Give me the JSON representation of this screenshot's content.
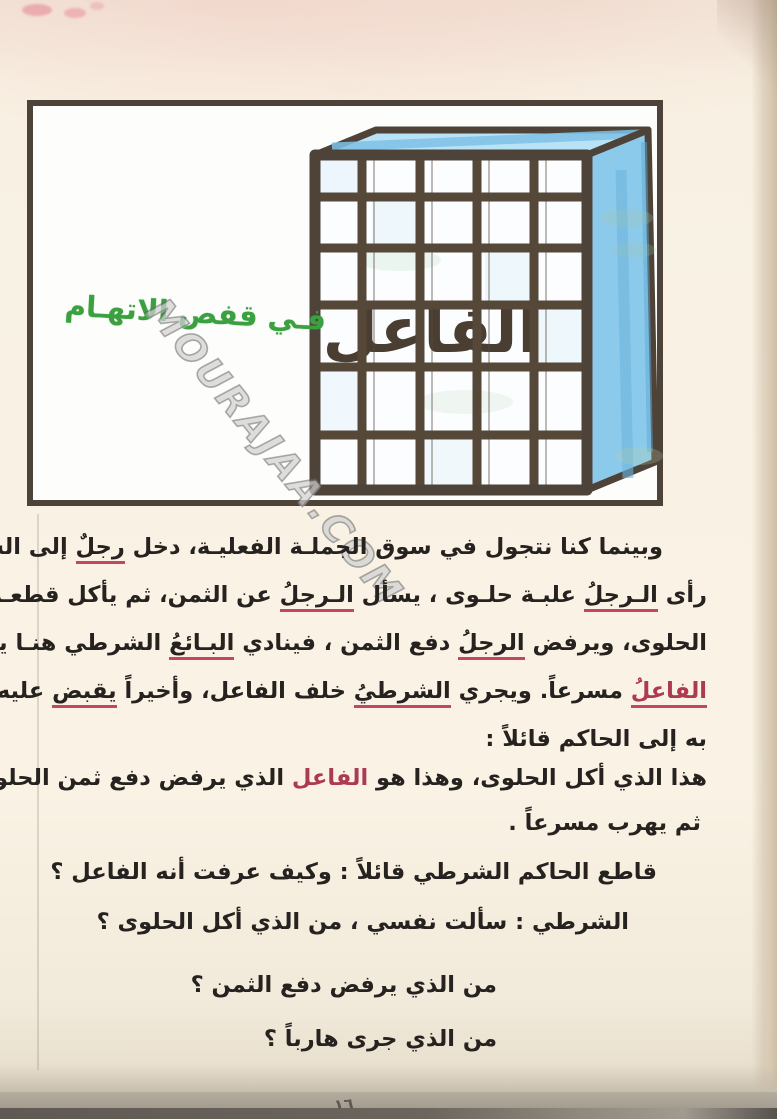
{
  "page": {
    "number": "١٦"
  },
  "colors": {
    "paper": "#f8f1e3",
    "frame_border": "#4e4338",
    "cage_bars": "#554838",
    "cage_side_blue": "#8ccaec",
    "cage_top_blue": "#b8e2f5",
    "title_green": "#3aa040",
    "highlight_red": "#ad3a53",
    "body_text": "#26221f"
  },
  "illustration": {
    "title": "فـي قفص الاتهـام",
    "cage_word": "الفاعل",
    "watermark": "MOURAJAA.COM"
  },
  "story": {
    "p1": {
      "lines": [
        [
          {
            "text": "وبينما كنا نتجول في سوق الجملـة الفعليـة، دخل ",
            "style": "normal"
          },
          {
            "text": "رجلٌ",
            "style": "underline"
          },
          {
            "text": " إلى السـوق،",
            "style": "normal"
          }
        ],
        [
          {
            "text": "رأى ",
            "style": "normal"
          },
          {
            "text": "الـرجلُ",
            "style": "underline"
          },
          {
            "text": " علبـة حلـوى ، يسأل ",
            "style": "normal"
          },
          {
            "text": "الـرجلُ",
            "style": "underline"
          },
          {
            "text": " عن الثمن، ثم يأكل قطعـة من",
            "style": "normal"
          }
        ],
        [
          {
            "text": "الحلوى، ويرفض ",
            "style": "normal"
          },
          {
            "text": "الرجلُ",
            "style": "underline"
          },
          {
            "text": " دفع الثمن ، فينادي ",
            "style": "normal"
          },
          {
            "text": "البـائعُ",
            "style": "underline"
          },
          {
            "text": " الشرطي هنـا يـهرب",
            "style": "normal"
          }
        ],
        [
          {
            "text": "الفاعلُ",
            "style": "red-underline"
          },
          {
            "text": " مسرعاً. ويجري ",
            "style": "normal"
          },
          {
            "text": "الشرطيُ",
            "style": "underline"
          },
          {
            "text": " خلف الفاعل، وأخيراً ",
            "style": "normal"
          },
          {
            "text": "يقبض",
            "style": "underline"
          },
          {
            "text": " عليه ويذهب",
            "style": "normal"
          }
        ],
        [
          {
            "text": "به إلى الحاكم قائلاً :",
            "style": "normal"
          }
        ]
      ]
    },
    "p2": {
      "lines": [
        [
          {
            "text": "هذا الذي أكل الحلوى، وهذا هو ",
            "style": "normal"
          },
          {
            "text": "الفاعل",
            "style": "red"
          },
          {
            "text": " الذي يرفض دفع ثمن الحلوى",
            "style": "normal"
          }
        ],
        [
          {
            "text": "ثم يهرب مسرعاً .",
            "style": "normal"
          }
        ]
      ]
    },
    "p3": {
      "text": "قاطع الحاكم الشرطي قائلاً : وكيف عرفت أنه الفاعل ؟"
    },
    "p4": {
      "text": "الشرطي : سألت نفسي ،  من الذي أكل الحلوى ؟"
    },
    "p5": {
      "text": "من الذي يرفض دفع الثمن ؟"
    },
    "p6": {
      "text": "من الذي جرى هارباً ؟"
    }
  }
}
